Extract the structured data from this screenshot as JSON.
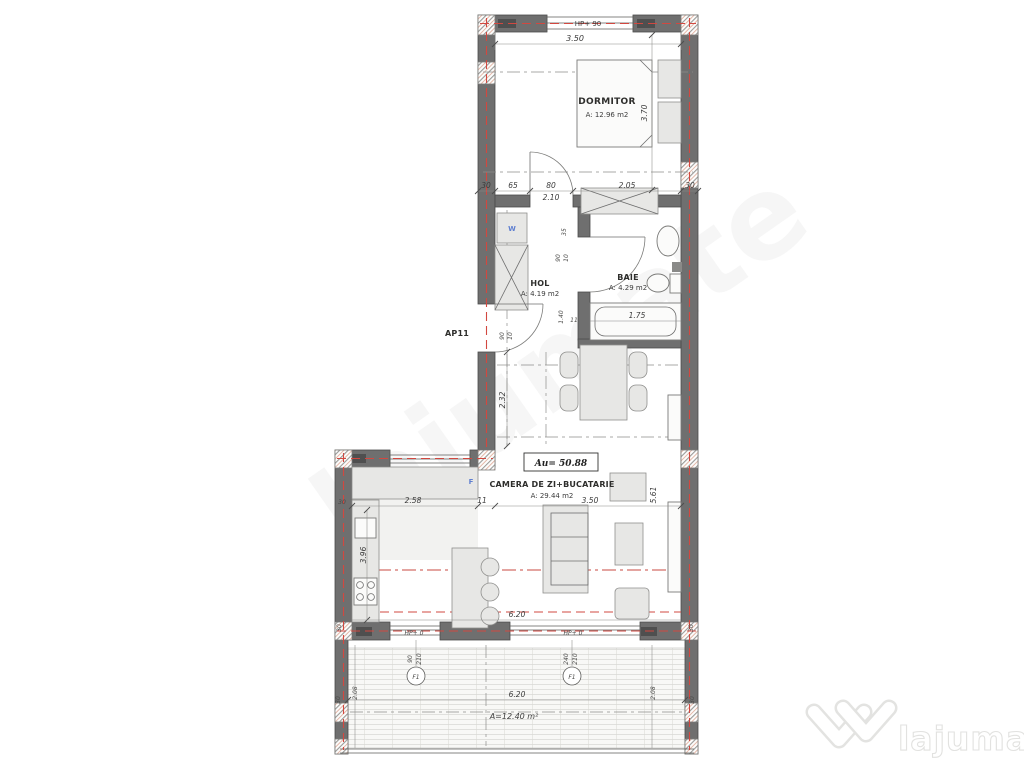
{
  "plan": {
    "apartment_label": "AP11",
    "total_area": "Au= 50.88",
    "rooms": {
      "dormitor": {
        "name": "DORMITOR",
        "area": "A: 12.96 m2"
      },
      "hol": {
        "name": "HOL",
        "area": "A: 4.19 m2"
      },
      "baie": {
        "name": "BAIE",
        "area": "A: 4.29 m2"
      },
      "living": {
        "name": "CAMERA DE ZI+BUCATARIE",
        "area": "A: 29.44 m2"
      },
      "terasa": {
        "area": "A=12.40 m²"
      }
    },
    "fixtures": {
      "washer": "W",
      "window": "F",
      "door_left": "F1",
      "door_right": "F1"
    },
    "openings": {
      "top_window": "HP+ 90",
      "bottom_left": "HP+ 0",
      "bottom_right": "HP+ 0"
    },
    "dims": {
      "top_width": "3.50",
      "wall30_tl": "30",
      "seg65": "65",
      "seg80": "80",
      "seg80_h": "2.10",
      "seg205": "2.05",
      "wall30_tr": "30",
      "bed_len": "3.70",
      "hall_35": "35",
      "hall_90": "90",
      "hall_10": "10",
      "tub_len": "1.75",
      "bath_140": "1.40",
      "bath_11": "11",
      "entry_90": "90",
      "entry_10": "10",
      "dining_232": "2.32",
      "kitchen_258": "2.58",
      "kitchen_11": "11",
      "kitchen_396": "3.96",
      "kitchen_30": "30",
      "living_350": "3.50",
      "living_561": "5.61",
      "bottom_620": "6.20",
      "bottom_30l": "30",
      "bottom_30r": "30",
      "door_90": "90",
      "door_210": "210",
      "door_240": "240",
      "door_210b": "210",
      "terrace_620": "6.20",
      "terrace_208l": "2.08",
      "terrace_208r": "2.08",
      "terrace_30l": "30",
      "terrace_30r": "30"
    },
    "colors": {
      "wall": "#6f6f6f",
      "axis_red": "#d24840",
      "label_blue": "#5f7fd0",
      "watermark_teal": "#cfe9e1"
    }
  },
  "watermark": {
    "brand": "lajumate",
    "tld": ".ro"
  }
}
